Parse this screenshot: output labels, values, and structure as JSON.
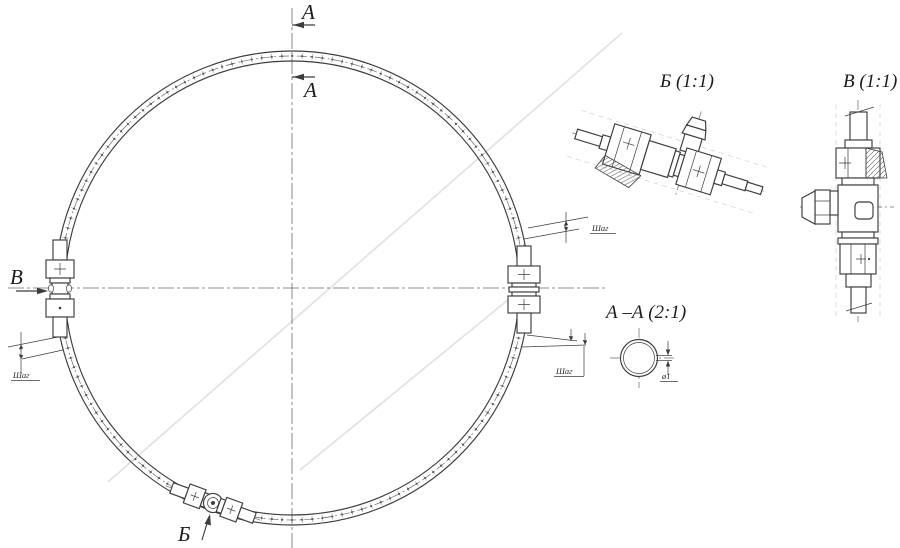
{
  "drawing": {
    "colors": {
      "line": "#3c3c3c",
      "centerline": "#6a6a6a",
      "background": "#ffffff",
      "artifact": "#e3e3e3"
    },
    "markers": {
      "section_a_upper": "А",
      "section_a_lower": "А",
      "view_v": "В",
      "view_b": "Б"
    },
    "details": {
      "detail_b_title": "Б (1:1)",
      "detail_v_title": "В (1:1)",
      "section_aa_title": "А –А (2:1)"
    },
    "dimensions": {
      "pitch_left": "Шаг",
      "pitch_upper_right": "Шаг",
      "pitch_lower_right": "Шаг",
      "hole_diameter": "ø1"
    },
    "ring": {
      "center_x": 292,
      "center_y": 288,
      "outer_r": 237,
      "inner_r": 227,
      "mid_r": 232,
      "hole_marks": 144
    }
  }
}
